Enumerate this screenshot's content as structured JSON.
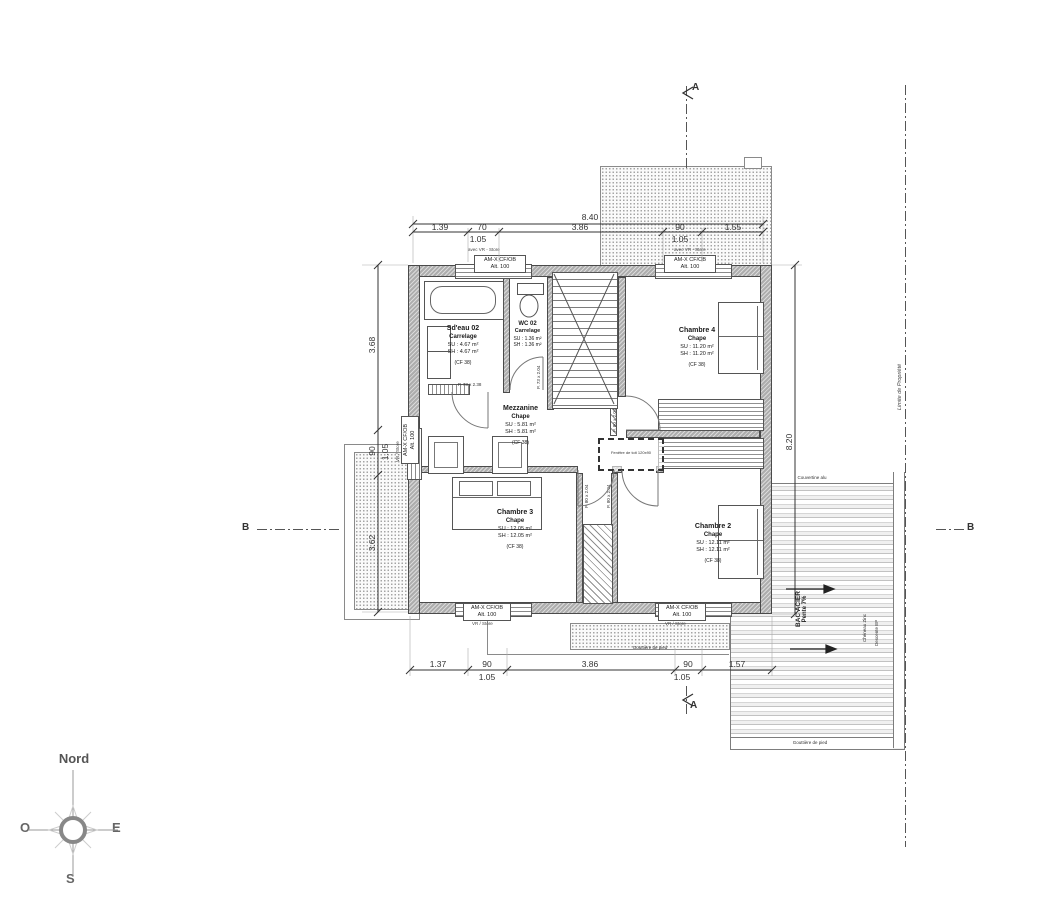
{
  "compass": {
    "north": "Nord",
    "west": "O",
    "east": "E",
    "south": "S"
  },
  "sections": {
    "a": "A",
    "b": "B"
  },
  "dims": {
    "top_total": "8.40",
    "top": [
      "1.39",
      "70",
      "3.86",
      "90",
      "1.55"
    ],
    "top_sub": [
      "1.05",
      "1.05"
    ],
    "bottom": [
      "1.37",
      "90",
      "3.86",
      "90",
      "1.57"
    ],
    "bottom_sub": [
      "1.05",
      "1.05"
    ],
    "left": [
      "3.68",
      "90",
      "3.62"
    ],
    "left_sub": "1.05",
    "right": "8.20"
  },
  "rooms": {
    "sdeau": {
      "name": "Sd'eau 02",
      "floor": "Carrelage",
      "su": "SU : 4.67 m²",
      "sh": "SH : 4.67 m²",
      "cf": "(CF 38)"
    },
    "wc": {
      "name": "WC 02",
      "floor": "Carrelage",
      "su": "SU : 1.36 m²",
      "sh": "SH : 1.36 m²"
    },
    "mezzanine": {
      "name": "Mezzanine",
      "floor": "Chape",
      "su": "SU : 5.81 m²",
      "sh": "SH : 5.81 m²",
      "cf": "(CF 38)"
    },
    "ch4": {
      "name": "Chambre 4",
      "floor": "Chape",
      "su": "SU : 11.20 m²",
      "sh": "SH : 11.20 m²",
      "cf": "(CF 38)"
    },
    "ch3": {
      "name": "Chambre 3",
      "floor": "Chape",
      "su": "SU : 12.05 m²",
      "sh": "SH : 12.05 m²",
      "cf": "(CF 38)"
    },
    "ch2": {
      "name": "Chambre 2",
      "floor": "Chape",
      "su": "SU : 12.11 m²",
      "sh": "SH : 12.11 m²",
      "cf": "(CF 38)"
    }
  },
  "windows": {
    "name": "AM-X CF/OB",
    "alt": "Alt. 100",
    "note_top_left": "avec VR - Store",
    "note_top_right": "avec VR - Store",
    "note_bottom_left": "VR / Store",
    "note_bottom_right": "VR / Store",
    "note_left": "VR / Store"
  },
  "doors": {
    "p73": "P. 73 x 2.04",
    "p73b": "P. 73 x 2.38",
    "p80": "P. 80 x 2.04"
  },
  "annotations": {
    "bac_acier": "BAC ACIER",
    "pente": "Pente 7%",
    "limite": "Limite de Propriété",
    "couvertine": "Couvertine alu",
    "gouttiere_1": "Gouttière de pied",
    "gouttiere_2": "Gouttière de pied",
    "cheneau": "Chéneau Zinc",
    "descente": "Descente EP",
    "skylight": "Fenêtre de toit 120x90"
  }
}
